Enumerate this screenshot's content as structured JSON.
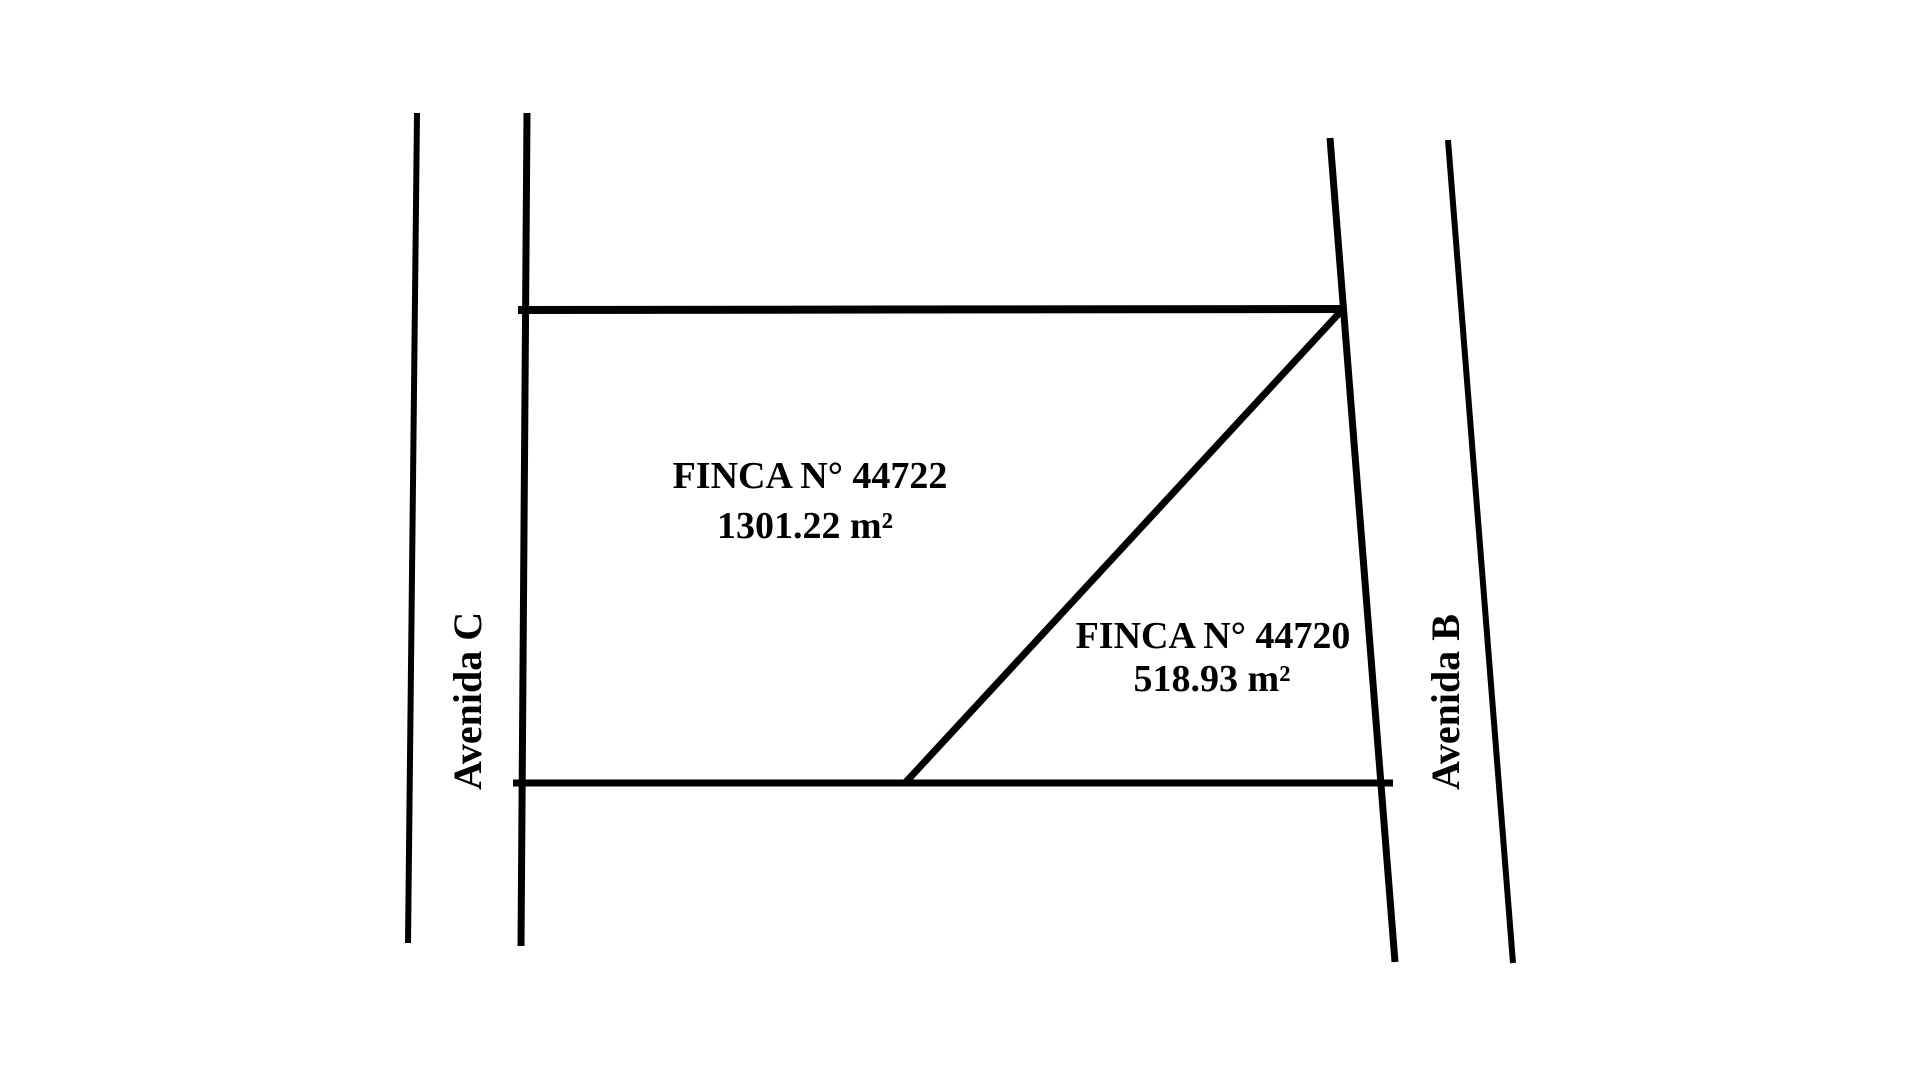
{
  "diagram": {
    "title": "cadastral-site-plan",
    "colors": {
      "background": "#ffffff",
      "line": "#000000",
      "text": "#000000"
    },
    "streets": {
      "left": {
        "label": "Avenida C"
      },
      "right": {
        "label": "Avenida B"
      }
    },
    "parcels": [
      {
        "name": "FINCA N° 44722",
        "area": "1301.22 m²"
      },
      {
        "name": "FINCA N° 44720",
        "area": "518.93 m²"
      }
    ]
  }
}
